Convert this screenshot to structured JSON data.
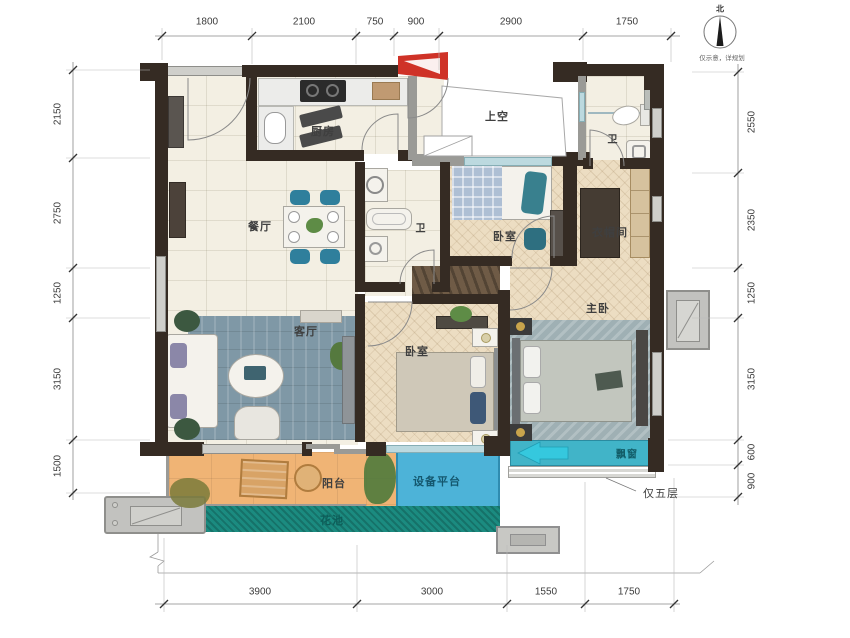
{
  "title": "户型图 (floor plan)",
  "compass": {
    "north": "北",
    "note": "仅示意，详规划"
  },
  "dimensions": {
    "top": [
      "1800",
      "2100",
      "750",
      "900",
      "2900",
      "1750"
    ],
    "bottom": [
      "3900",
      "3000",
      "1550",
      "1750"
    ],
    "left": [
      "2150",
      "2750",
      "1250",
      "3150",
      "1500"
    ],
    "right": [
      "2550",
      "2350",
      "1250",
      "3150",
      "600",
      "900"
    ]
  },
  "rooms": {
    "kitchen": "厨房",
    "void": "上空",
    "bath_top": "卫",
    "bath_mid": "卫",
    "dining": "餐厅",
    "bedroom_top": "卧室",
    "closet": "衣帽间",
    "master_bedroom": "主卧",
    "living": "客厅",
    "bedroom_second": "卧室",
    "balcony": "阳台",
    "equipment_platform": "设备平台",
    "flower_bed": "花池",
    "bay_window": "飘窗"
  },
  "annotations": {
    "floor_note": "仅五层"
  },
  "colors": {
    "wall": "#352b23",
    "floor_tile": "#f3efe3",
    "wood_floor": "#ecddc2",
    "balcony": "#f0b475",
    "equipment_platform": "#4db3d8",
    "flower_bed": "#1b8b80",
    "bay_window": "#41b4c8",
    "entry_arrow": "#cf3227",
    "dining_chair": "#2f7f9c",
    "living_rug": "#7f98a6"
  }
}
